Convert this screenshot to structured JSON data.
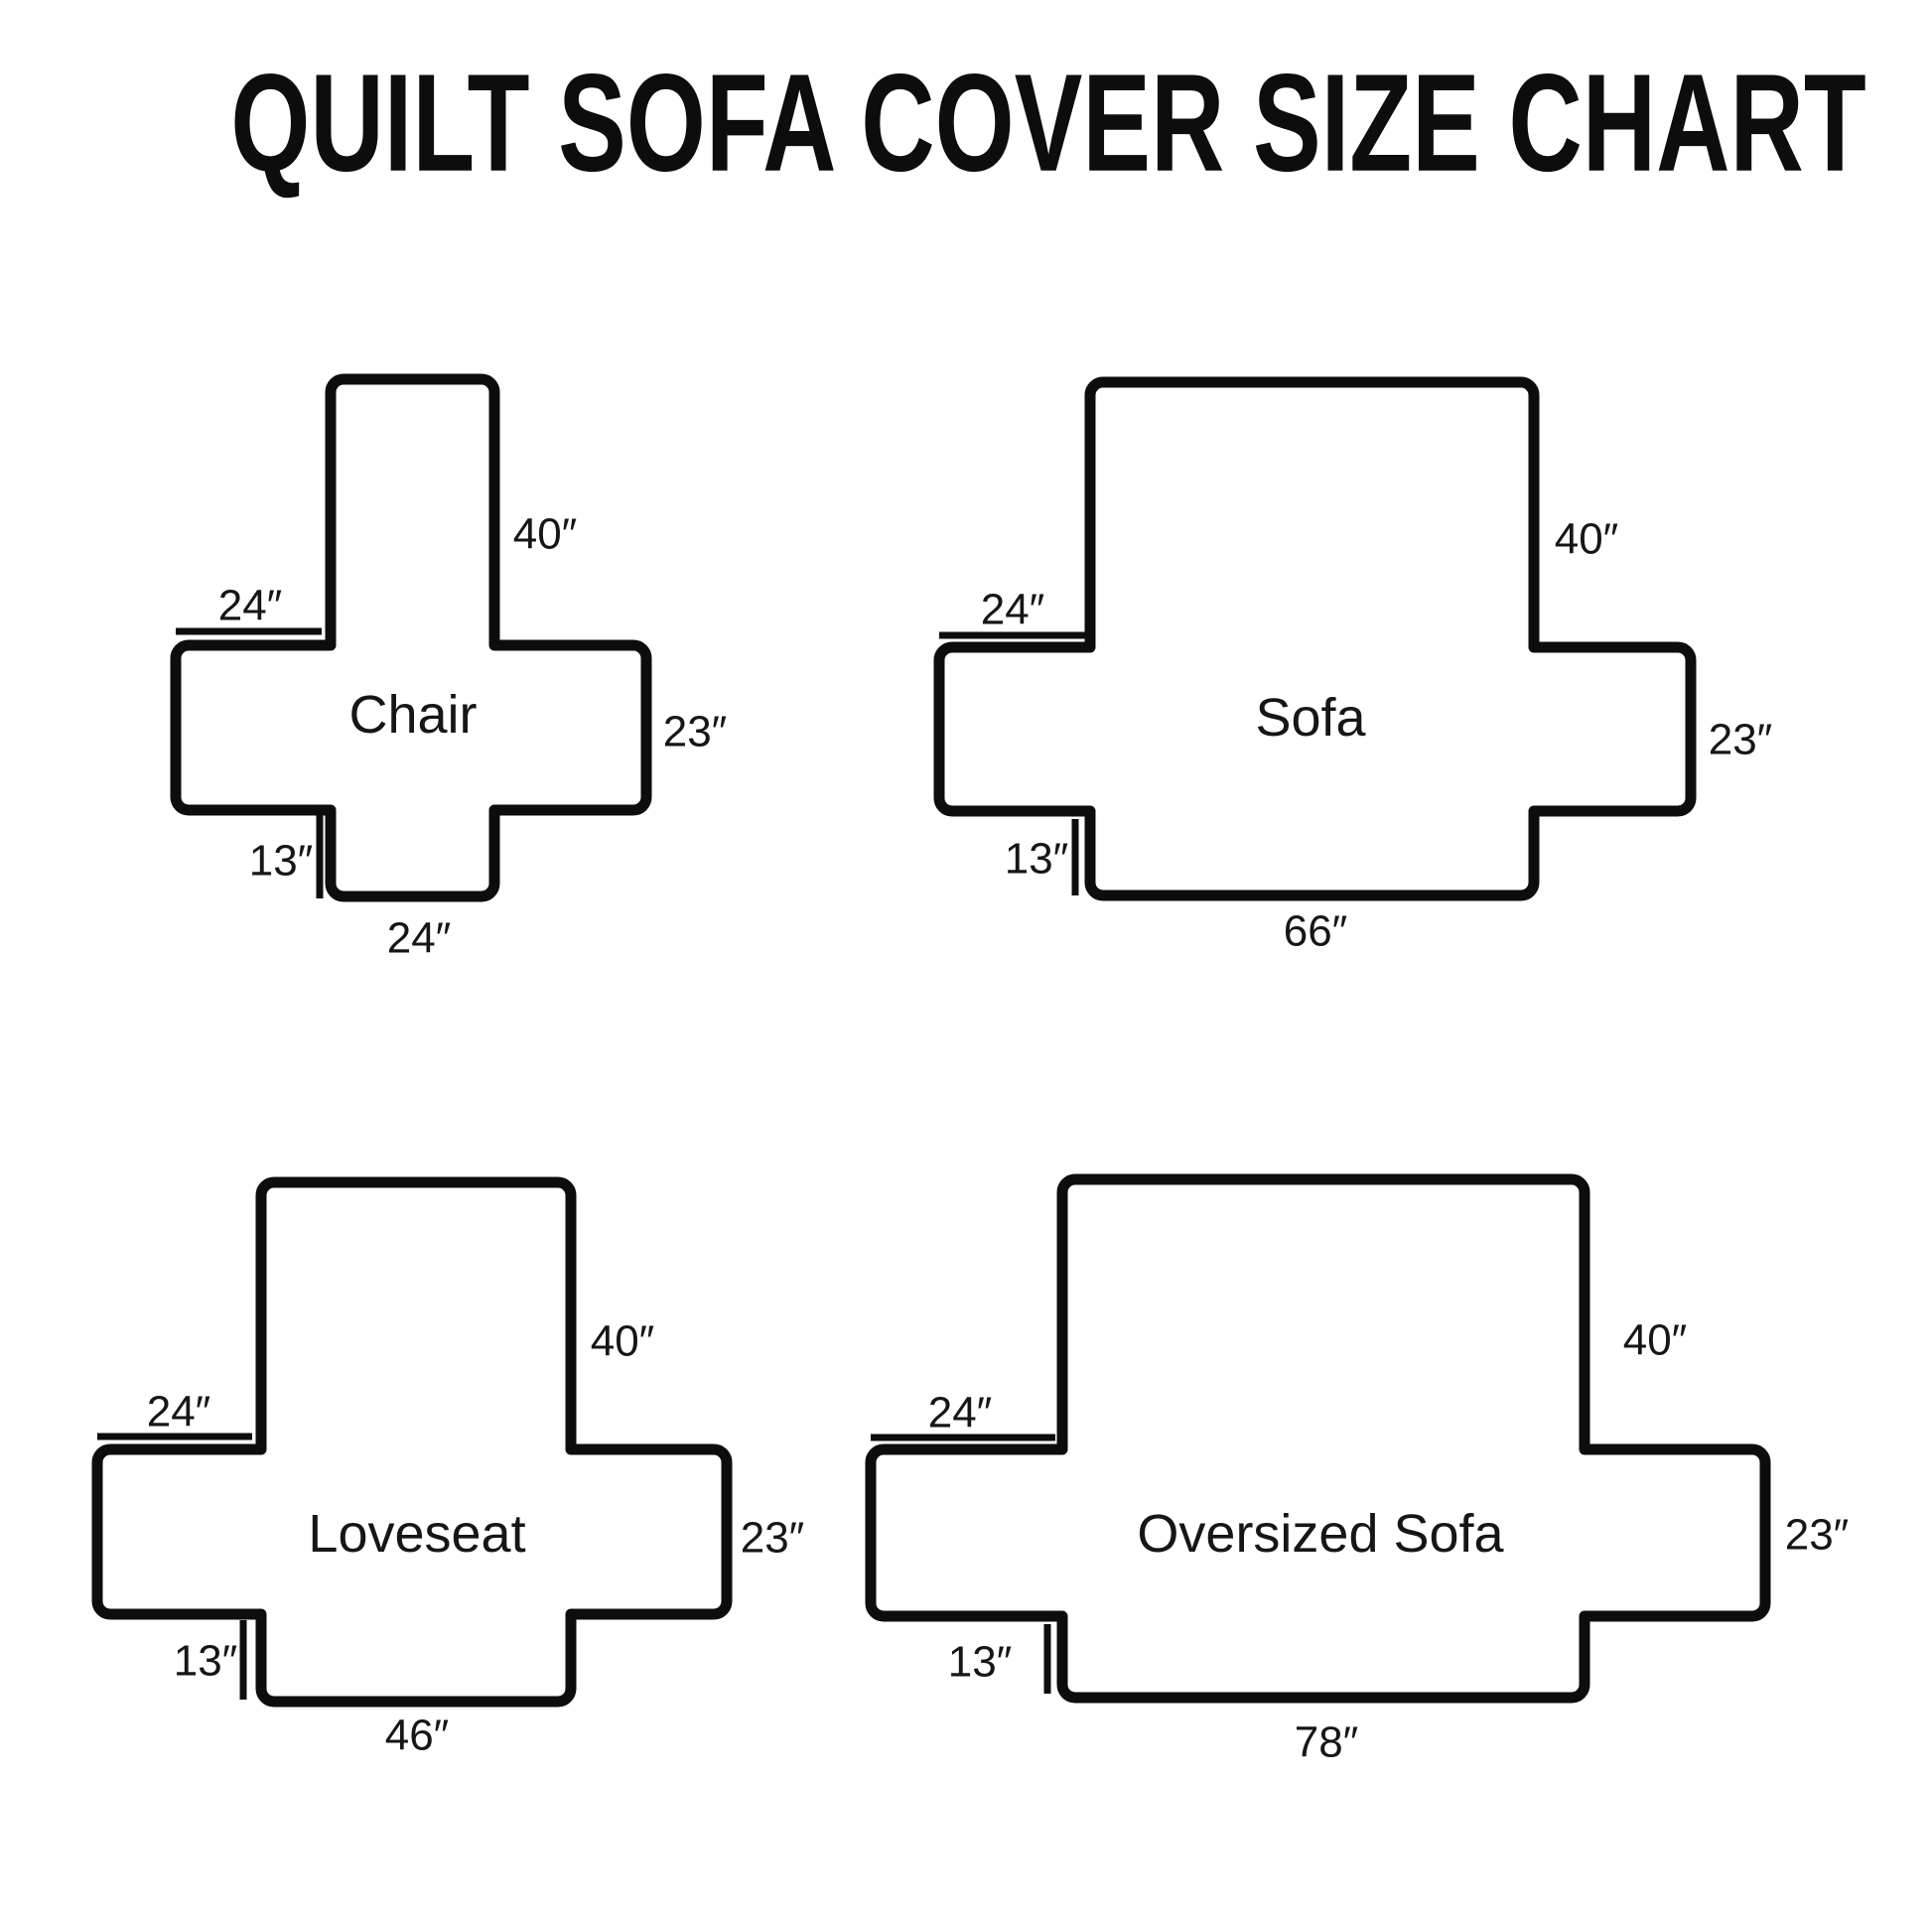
{
  "title": "QUILT SOFA COVER SIZE CHART",
  "colors": {
    "background": "#ffffff",
    "line": "#0d0d0d",
    "text": "#161616"
  },
  "diagrams": {
    "chair": {
      "name": "Chair",
      "back_height": "40″",
      "arm_width": "24″",
      "side_depth": "23″",
      "skirt_drop": "13″",
      "bottom_width": "24″"
    },
    "sofa": {
      "name": "Sofa",
      "back_height": "40″",
      "arm_width": "24″",
      "side_depth": "23″",
      "skirt_drop": "13″",
      "bottom_width": "66″"
    },
    "loveseat": {
      "name": "Loveseat",
      "back_height": "40″",
      "arm_width": "24″",
      "side_depth": "23″",
      "skirt_drop": "13″",
      "bottom_width": "46″"
    },
    "oversized_sofa": {
      "name": "Oversized Sofa",
      "back_height": "40″",
      "arm_width": "24″",
      "side_depth": "23″",
      "skirt_drop": "13″",
      "bottom_width": "78″"
    }
  }
}
